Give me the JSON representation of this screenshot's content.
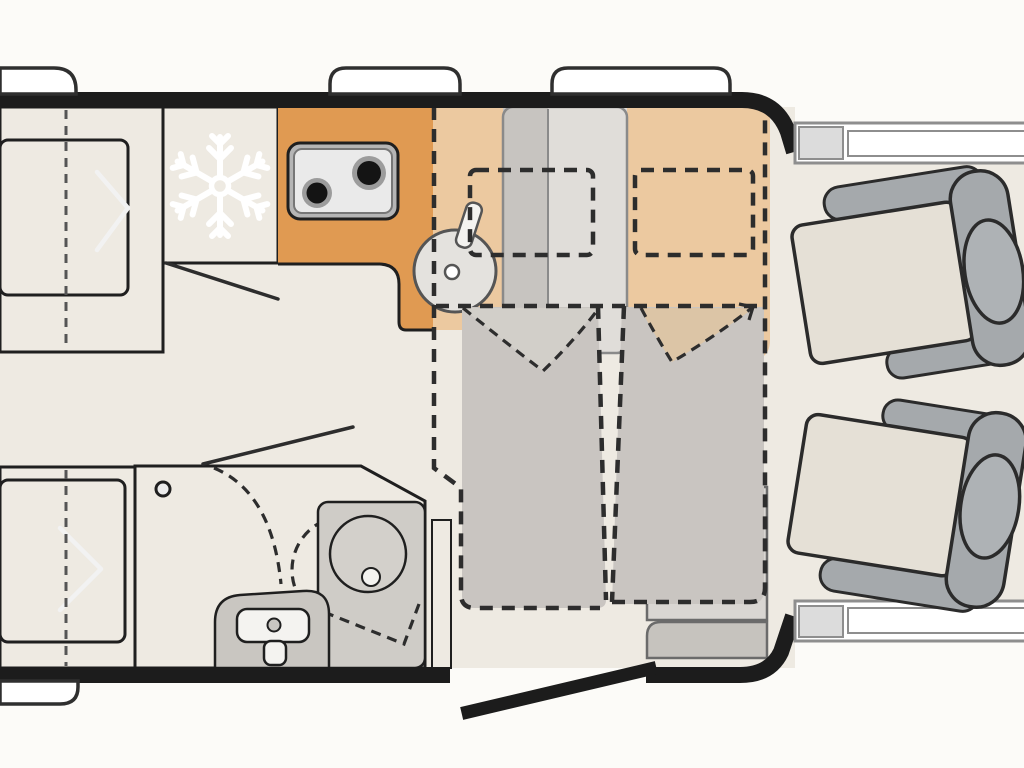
{
  "meta": {
    "view": "camper-van-floor-plan-top-view",
    "regions": {
      "rear_bed_top": "single-bed-rear-left-upper",
      "rear_bed_bottom": "single-bed-rear-left-lower",
      "kitchen": "kitchenette-with-fridge-stove-sink",
      "bathroom": "wet-room-with-toilet-basin-shower",
      "dinette": "seating-area-with-drop-down-beds",
      "cab": "driver-and-passenger-swivel-seats",
      "entry_door": "open-entry-door-bottom-right"
    },
    "icons": [
      "snowflake-icon",
      "stove-burners-icon",
      "sink-drain-icon",
      "toilet-icon",
      "fold-arrow-icon"
    ]
  },
  "colors": {
    "background": "#fcfbf8",
    "floor": "#eeeae2",
    "wall": "#1c1c1c",
    "outline": "#1f1f1f",
    "dash": "#2d2d2d",
    "centerline": "#555555",
    "cabinet_orange": "#e09a52",
    "bed_overlay_tan": "#ecc9a0",
    "platform_beige": "#e8e4da",
    "mattress_gray": "#a9a9a9",
    "fold_mark_white": "#f2f2f2",
    "bathroom_blue": "#c5d9ec",
    "fixture_gray": "#cfccc7",
    "fixture_white": "#f4f3f0",
    "bed_fill_gray": "#c9c5c1",
    "pillow_gray": "#bfbbb7",
    "v_fill_left": "#d2cfc9",
    "v_fill_right": "#dcc5a6",
    "strip_dark": "#c7c4c0",
    "strip_light": "#e0ddd9",
    "strip_line": "#8a8a8a",
    "bench_gray": "#d9d6d2",
    "bench_base_gray": "#c6c3be",
    "bench_line": "#6b6b6b",
    "stove_body": "#b5b5b5",
    "stove_top": "#eaeaea",
    "burner_ring": "#9c9c9c",
    "burner_black": "#141414",
    "sink_fill": "#e4e2de",
    "sink_line": "#555555",
    "seat_cushion": "#e5e0d6",
    "seat_armrest": "#a5a9ac",
    "seat_headrest": "#aeb2b5",
    "seat_outline": "#2b2b2b",
    "door_bar_line": "#8e8e8e",
    "door_bar_block": "#dcdcdc",
    "pure_white": "#ffffff",
    "snowflake": "#ffffff"
  }
}
